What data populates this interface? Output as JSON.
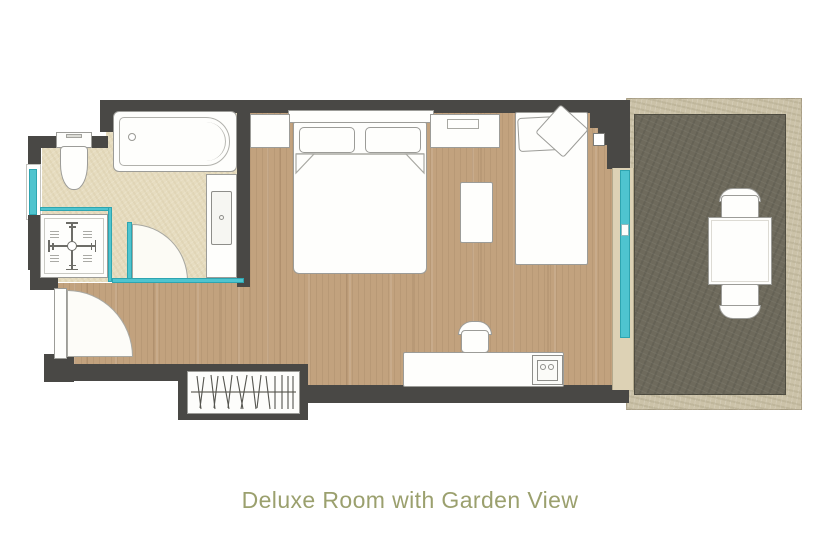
{
  "page": {
    "background_color": "#ffffff",
    "caption": "Deluxe Room with Garden View",
    "caption_color": "#9ba06e"
  },
  "floor_plan": {
    "type": "hotel-room-floor-plan",
    "colors": {
      "wall": "#494845",
      "wood": "#c2a27e",
      "bathfloor": "#e6dcbf",
      "terracefloor": "#6e6a5c",
      "stone": "#cbc2a8",
      "glass": "#4fc4cf",
      "outline": "#9c9c98"
    },
    "rooms": [
      {
        "name": "bathroom",
        "elements": [
          "bathtub",
          "toilet",
          "walk-in-shower",
          "shower-valve",
          "vanity-sink",
          "glass-partition",
          "pivot-door",
          "window"
        ]
      },
      {
        "name": "bedroom",
        "elements": [
          "double-bed",
          "pillows",
          "nightstand",
          "console-table",
          "daybed",
          "cushions",
          "ottoman",
          "desk",
          "desk-chair",
          "minibar-sink",
          "wardrobe",
          "entrance-door",
          "sliding-glass-door"
        ]
      },
      {
        "name": "terrace",
        "elements": [
          "outdoor-table",
          "outdoor-chair",
          "outdoor-chair"
        ]
      }
    ]
  }
}
